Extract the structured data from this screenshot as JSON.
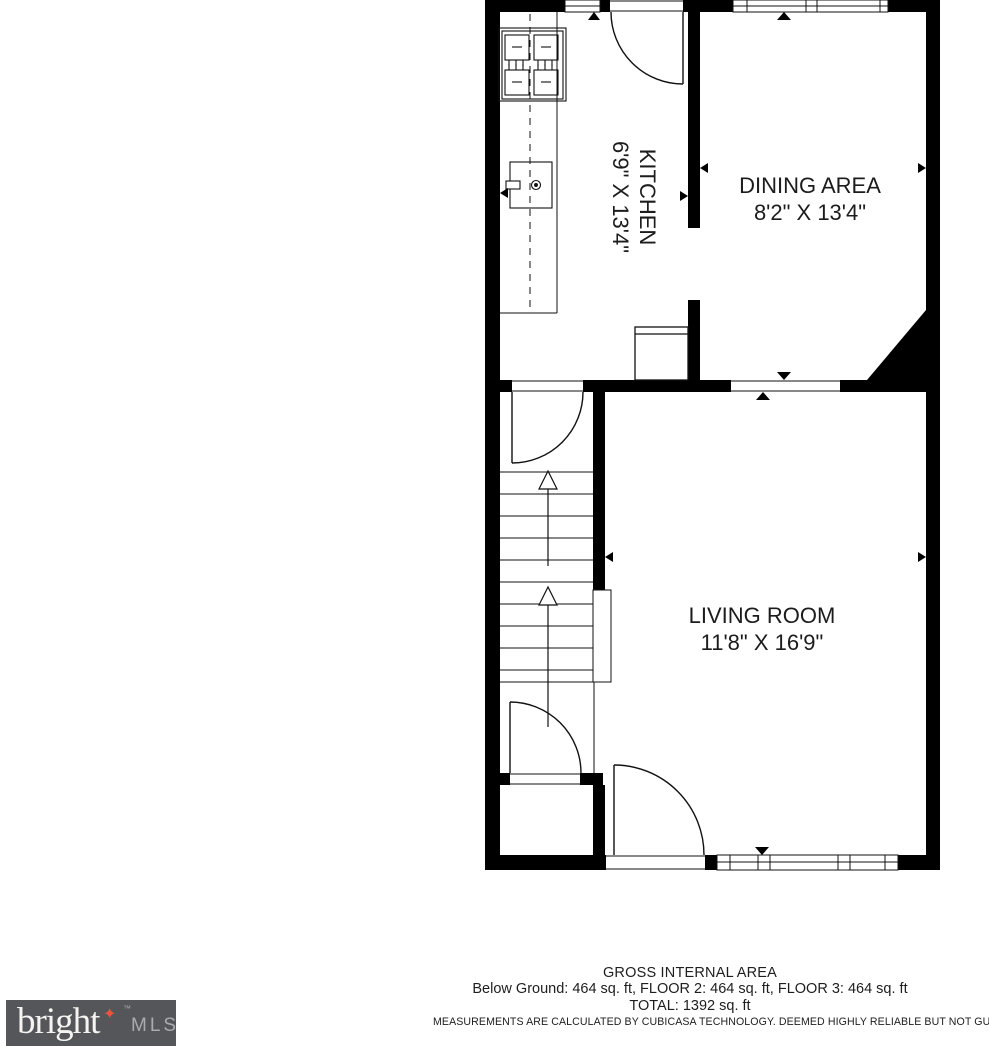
{
  "rooms": [
    {
      "id": "kitchen",
      "name": "KITCHEN",
      "dims": "6'9\" X 13'4\""
    },
    {
      "id": "dining",
      "name": "DINING AREA",
      "dims": "8'2\" X 13'4\""
    },
    {
      "id": "living",
      "name": "LIVING ROOM",
      "dims": "11'8\" X 16'9\""
    }
  ],
  "footer": {
    "title": "GROSS INTERNAL AREA",
    "areas": "Below Ground: 464 sq. ft, FLOOR 2: 464 sq. ft, FLOOR 3: 464 sq. ft",
    "total": "TOTAL: 1392 sq. ft",
    "disclaimer": "MEASUREMENTS ARE CALCULATED BY CUBICASA TECHNOLOGY. DEEMED HIGHLY RELIABLE BUT NOT GUARANTEED"
  },
  "logo": {
    "brand": "bright",
    "mls": "MLS",
    "trademark": "™",
    "star_glyph": "✦",
    "bg_color": "#55565a",
    "star_color": "#e8553c"
  },
  "colors": {
    "wall": "#000000",
    "line": "#111111",
    "text": "#1c1c1c"
  }
}
